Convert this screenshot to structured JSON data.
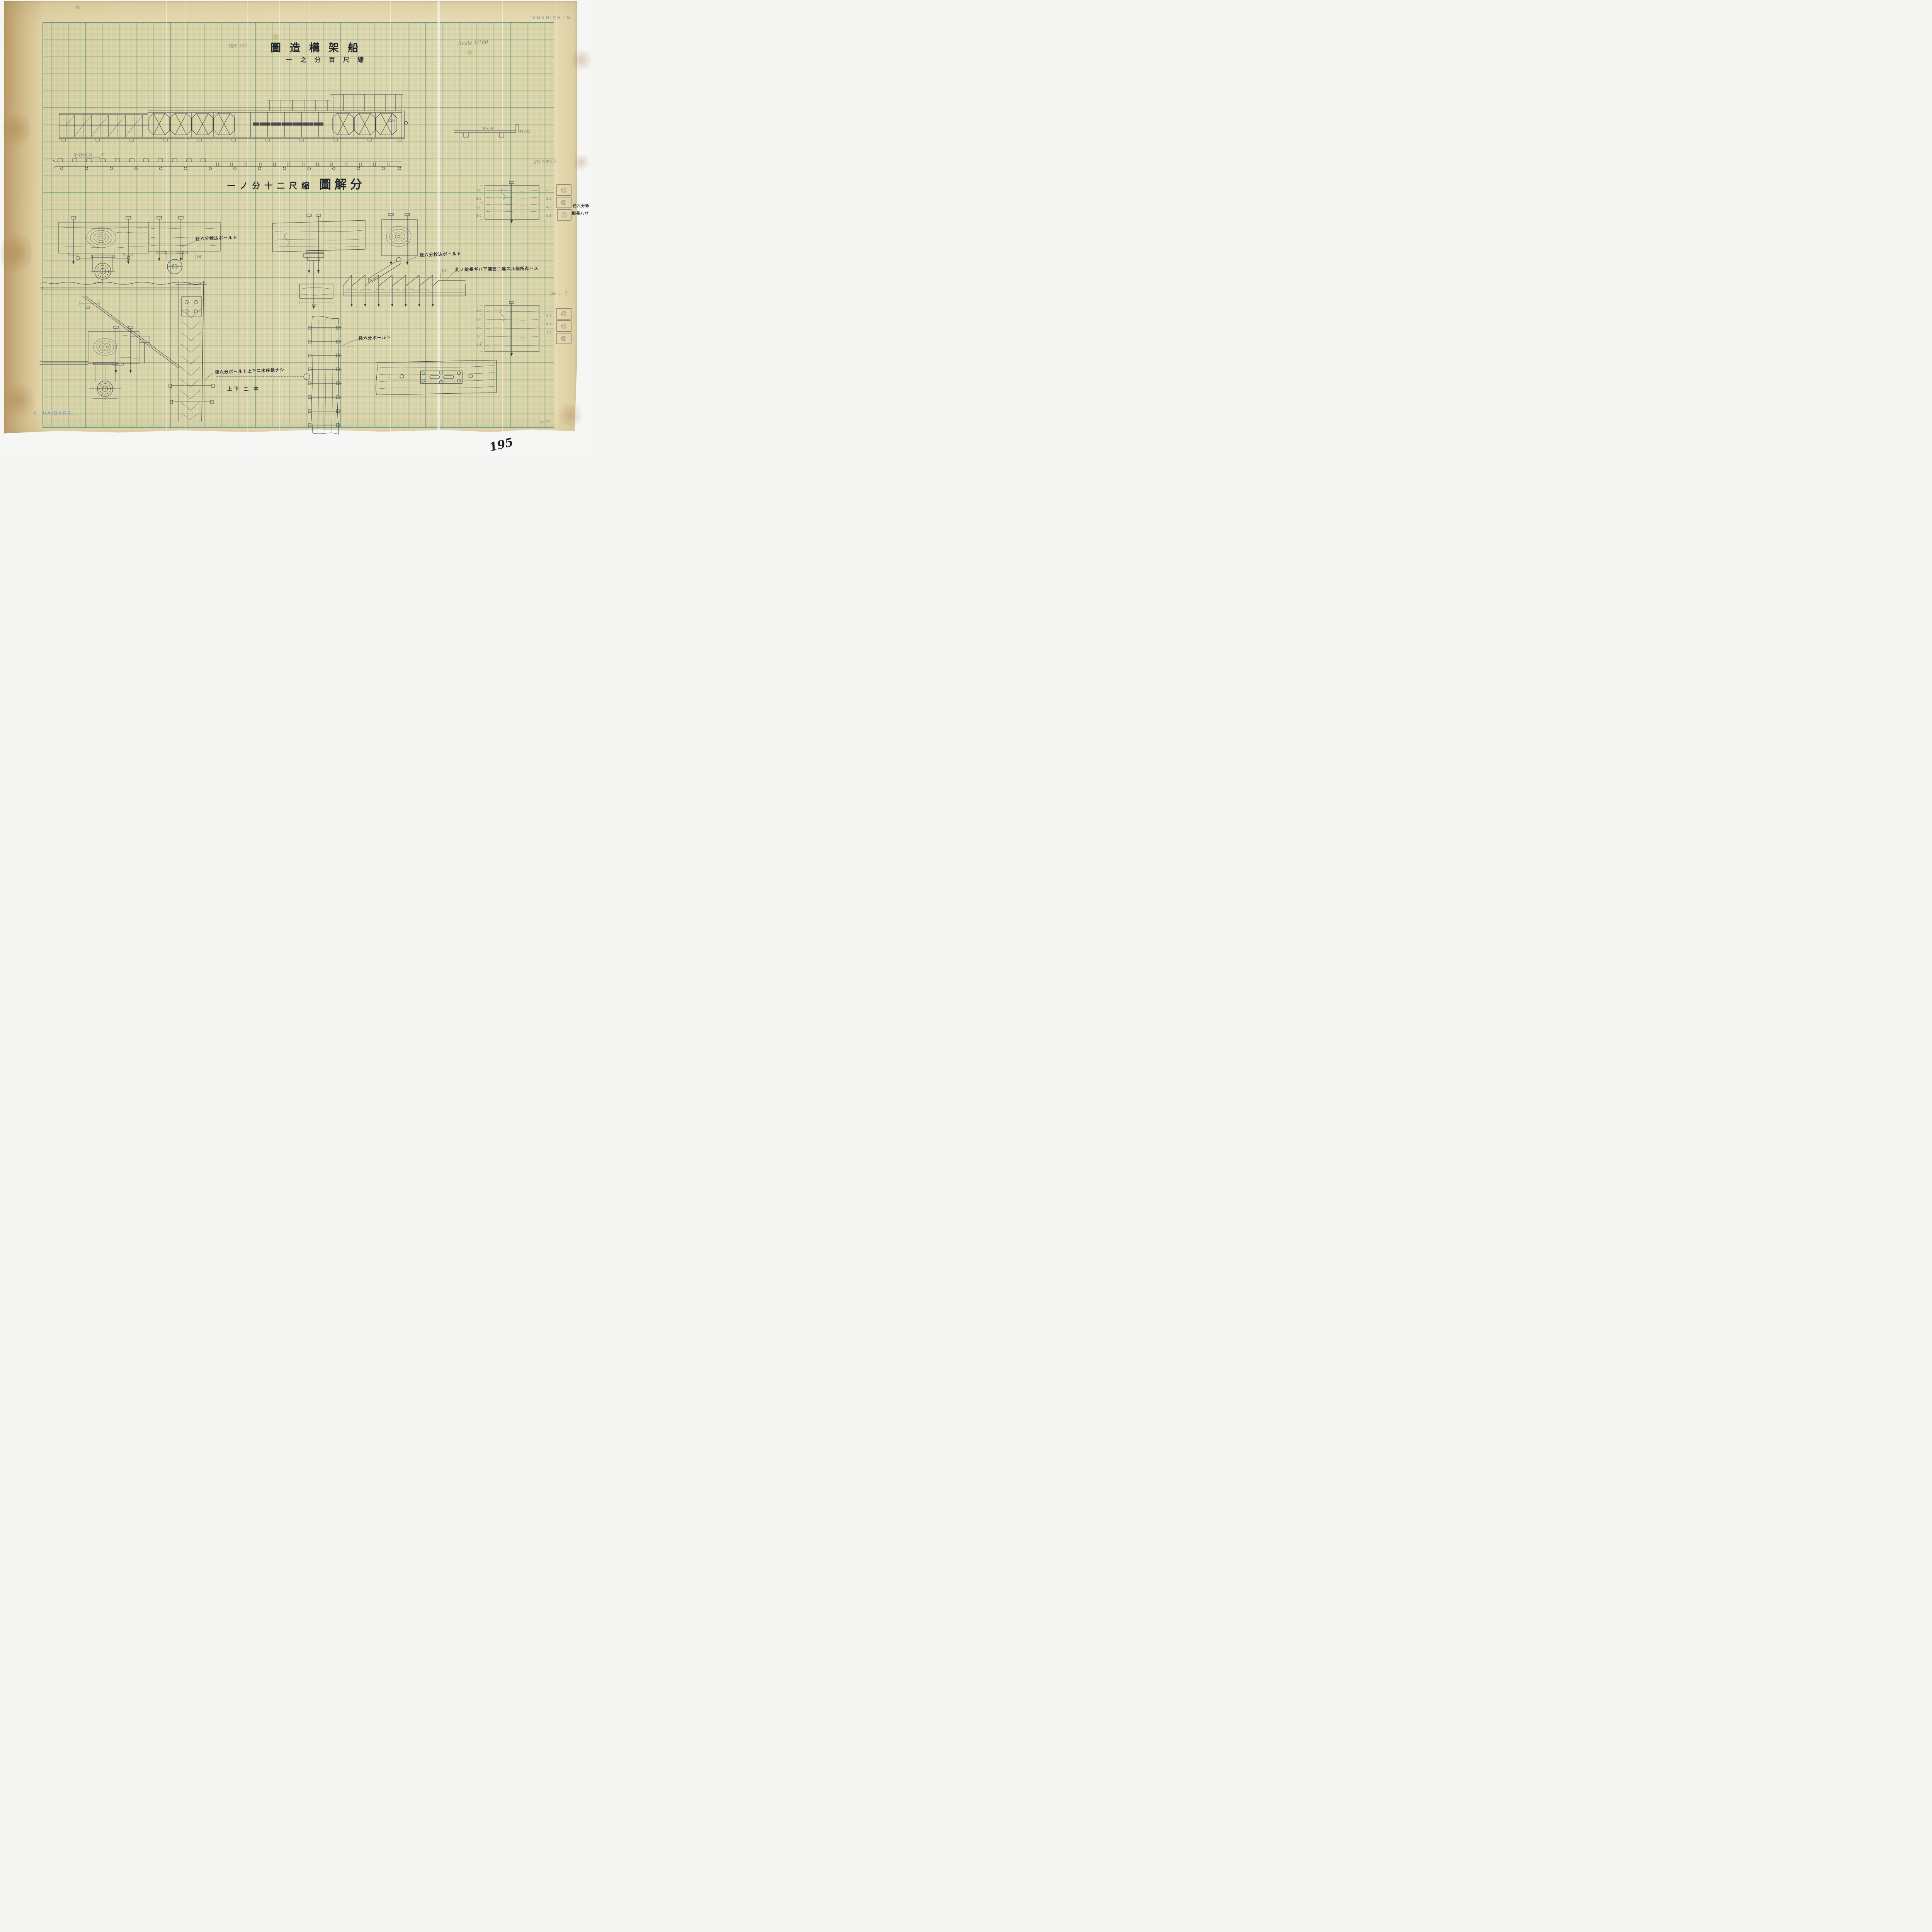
{
  "stamps": {
    "maker": "N. HAIBARA.",
    "maker_top": "N. HAIBARA."
  },
  "page": {
    "number": "195",
    "pencil_no": "No 21"
  },
  "titles": {
    "main": "圖造構架船",
    "subtitle": "一之分百尺縮",
    "detail_prefix": "一ノ分十二尺縮",
    "detail_main": "圖解分"
  },
  "pencil_notes": {
    "scale_en": "Scale 1/100",
    "scale_jp": "縮尺〈5′〉",
    "yamagata_top": "山形 三枚五分",
    "yamagata_right": "山形 五・五"
  },
  "annotations": {
    "bolt_left": "径六分栓込ボールト",
    "bolt_right": "径六分栓込ボールト",
    "total_length": "此ノ総長ギハ干潮面ニ達スル個所迄トス",
    "bolt_washers": "径六分ボールト上下ニ木座鉄ナシ",
    "two_bolts": "上下 二 本",
    "bolt_plain": "径六分ボールト",
    "rivet_line1": "径六分鋲",
    "rivet_line2": "胴長八寸"
  },
  "dimensions": {
    "plan_section": "5×20×0.20",
    "plan_len": "4′",
    "frag_a": "50×40",
    "frag_b": "30×31",
    "elev_height": "52½",
    "brace_offset": "12′",
    "block_w": "1′0″",
    "block_h": "1′6″",
    "rack_t": "1½″",
    "plank_w": "1′0″"
  },
  "right_sections": {
    "top": {
      "left_dims": [
        "7,0",
        "5,0",
        "7,6",
        "5,0"
      ],
      "right_dims": [
        "6″",
        "1,0",
        "4,0",
        "0,8"
      ]
    },
    "bottom": {
      "left_dims": [
        "1,0",
        "3,0",
        "1,0",
        "1,0",
        "1,5"
      ],
      "right_dims": [
        "0,8",
        "0,5",
        "1,0"
      ]
    }
  }
}
